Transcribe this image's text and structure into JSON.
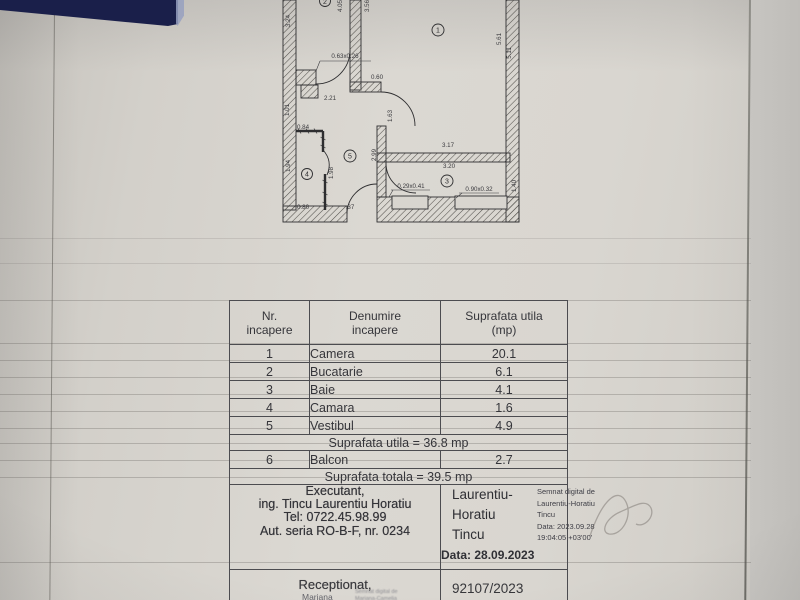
{
  "floor_plan": {
    "rooms": [
      "1",
      "2",
      "3",
      "4",
      "5"
    ],
    "dims": [
      "3.24",
      "4.05",
      "3.56",
      "5.61",
      "5.11",
      "0.63x0.26",
      "0.60",
      "2.21",
      "1.01",
      "1.63",
      "2.99",
      "3.17",
      "3.20",
      "0.84",
      "1.94",
      "1.98",
      "0.80",
      ".37",
      "0.29x0.41",
      "0.90x0.32",
      "1.40"
    ]
  },
  "table": {
    "headers": [
      "Nr.\nincapere",
      "Denumire\nincapere",
      "Suprafata utila\n(mp)"
    ],
    "rows": [
      {
        "num": "1",
        "name": "Camera",
        "area": "20.1"
      },
      {
        "num": "2",
        "name": "Bucatarie",
        "area": "6.1"
      },
      {
        "num": "3",
        "name": "Baie",
        "area": "4.1"
      },
      {
        "num": "4",
        "name": "Camara",
        "area": "1.6"
      },
      {
        "num": "5",
        "name": "Vestibul",
        "area": "4.9"
      }
    ],
    "useful_area_row": "Suprafata utila = 36.8 mp",
    "balcony": {
      "num": "6",
      "name": "Balcon",
      "area": "2.7"
    },
    "total_area_row": "Suprafata totala = 39.5 mp"
  },
  "executant": {
    "title": "Executant,",
    "name": "ing. Tincu Laurentiu Horatiu",
    "phone": "Tel: 0722.45.98.99",
    "authorization": "Aut. seria RO-B-F, nr. 0234"
  },
  "signature": {
    "name": "Laurentiu-\nHoratiu\nTincu",
    "date": "Data: 28.09.2023",
    "stamp": "Semnat digital de\nLaurentiu-Horatiu\nTincu\nData: 2023.09.28\n19:04:05 +03'00'"
  },
  "reception": {
    "title": "Receptionat,",
    "name": "Mariana\nCamelia",
    "stamp": "Semnat digital de\nMariana-Camelia",
    "number": "92107/2023"
  }
}
